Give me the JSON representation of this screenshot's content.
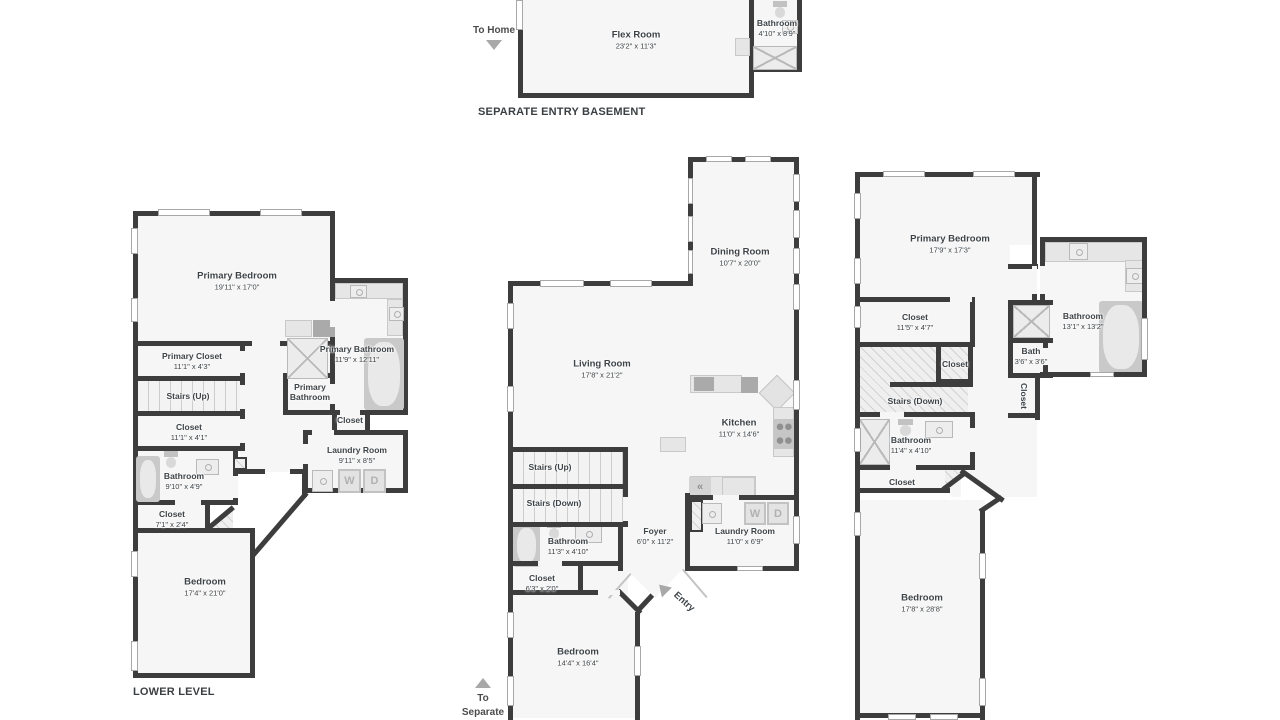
{
  "colors": {
    "wall": "#3d3d3d",
    "floor": "#f6f6f6",
    "text": "#3d4347",
    "fixture": "#e6e6e6",
    "window_trim": "#a8a8a8",
    "arrow": "#a8a8a8"
  },
  "icons": {
    "fridge": "«"
  },
  "levels": {
    "basement": {
      "title": "SEPARATE ENTRY BASEMENT",
      "nav_to_home": "To Home",
      "rooms": {
        "flex": {
          "name": "Flex Room",
          "dims": "23'2\" x 11'3\""
        },
        "bath": {
          "name": "Bathroom",
          "dims": "4'10\" x 8'9\""
        }
      }
    },
    "lower": {
      "title": "LOWER LEVEL",
      "washer": "W",
      "dryer": "D",
      "rooms": {
        "primary_bedroom": {
          "name": "Primary Bedroom",
          "dims": "19'11\" x 17'0\""
        },
        "primary_closet": {
          "name": "Primary Closet",
          "dims": "11'1\" x 4'3\""
        },
        "stairs_up": {
          "name": "Stairs (Up)"
        },
        "closet_a": {
          "name": "Closet",
          "dims": "11'1\" x 4'1\""
        },
        "bathroom": {
          "name": "Bathroom",
          "dims": "9'10\" x 4'9\""
        },
        "closet_b": {
          "name": "Closet",
          "dims": "7'1\" x 2'4\""
        },
        "bedroom": {
          "name": "Bedroom",
          "dims": "17'4\" x 21'0\""
        },
        "primary_bathroom": {
          "name": "Primary Bathroom",
          "dims": "11'9\" x 12'11\""
        },
        "primary_bathroom_wc": {
          "name": "Primary Bathroom"
        },
        "closet_c": {
          "name": "Closet"
        },
        "laundry": {
          "name": "Laundry Room",
          "dims": "9'11\" x 8'5\""
        }
      }
    },
    "main": {
      "nav_separate_entry": "To Separate Entry",
      "entry_label": "Entry",
      "washer": "W",
      "dryer": "D",
      "rooms": {
        "dining": {
          "name": "Dining Room",
          "dims": "10'7\" x 20'0\""
        },
        "living": {
          "name": "Living Room",
          "dims": "17'8\" x 21'2\""
        },
        "kitchen": {
          "name": "Kitchen",
          "dims": "11'0\" x 14'6\""
        },
        "stairs_up": {
          "name": "Stairs (Up)"
        },
        "stairs_down": {
          "name": "Stairs (Down)"
        },
        "bathroom": {
          "name": "Bathroom",
          "dims": "11'3\" x 4'10\""
        },
        "foyer": {
          "name": "Foyer",
          "dims": "6'0\" x 11'2\""
        },
        "laundry": {
          "name": "Laundry Room",
          "dims": "11'0\" x 6'9\""
        },
        "closet": {
          "name": "Closet",
          "dims": "6'3\" x 2'0\""
        },
        "bedroom": {
          "name": "Bedroom",
          "dims": "14'4\" x 16'4\""
        }
      }
    },
    "upper": {
      "rooms": {
        "primary_bedroom": {
          "name": "Primary Bedroom",
          "dims": "17'9\" x 17'3\""
        },
        "closet_a": {
          "name": "Closet",
          "dims": "11'5\" x 4'7\""
        },
        "bathroom_primary": {
          "name": "Bathroom",
          "dims": "13'1\" x 13'2\""
        },
        "bath": {
          "name": "Bath",
          "dims": "3'6\" x 3'6\""
        },
        "closet_vertical": {
          "name": "Closet"
        },
        "stairs_down": {
          "name": "Stairs (Down)"
        },
        "closet_stairs": {
          "name": "Closet"
        },
        "bathroom": {
          "name": "Bathroom",
          "dims": "11'4\" x 4'10\""
        },
        "closet_b": {
          "name": "Closet"
        },
        "bedroom": {
          "name": "Bedroom",
          "dims": "17'8\" x 28'8\""
        }
      }
    }
  }
}
